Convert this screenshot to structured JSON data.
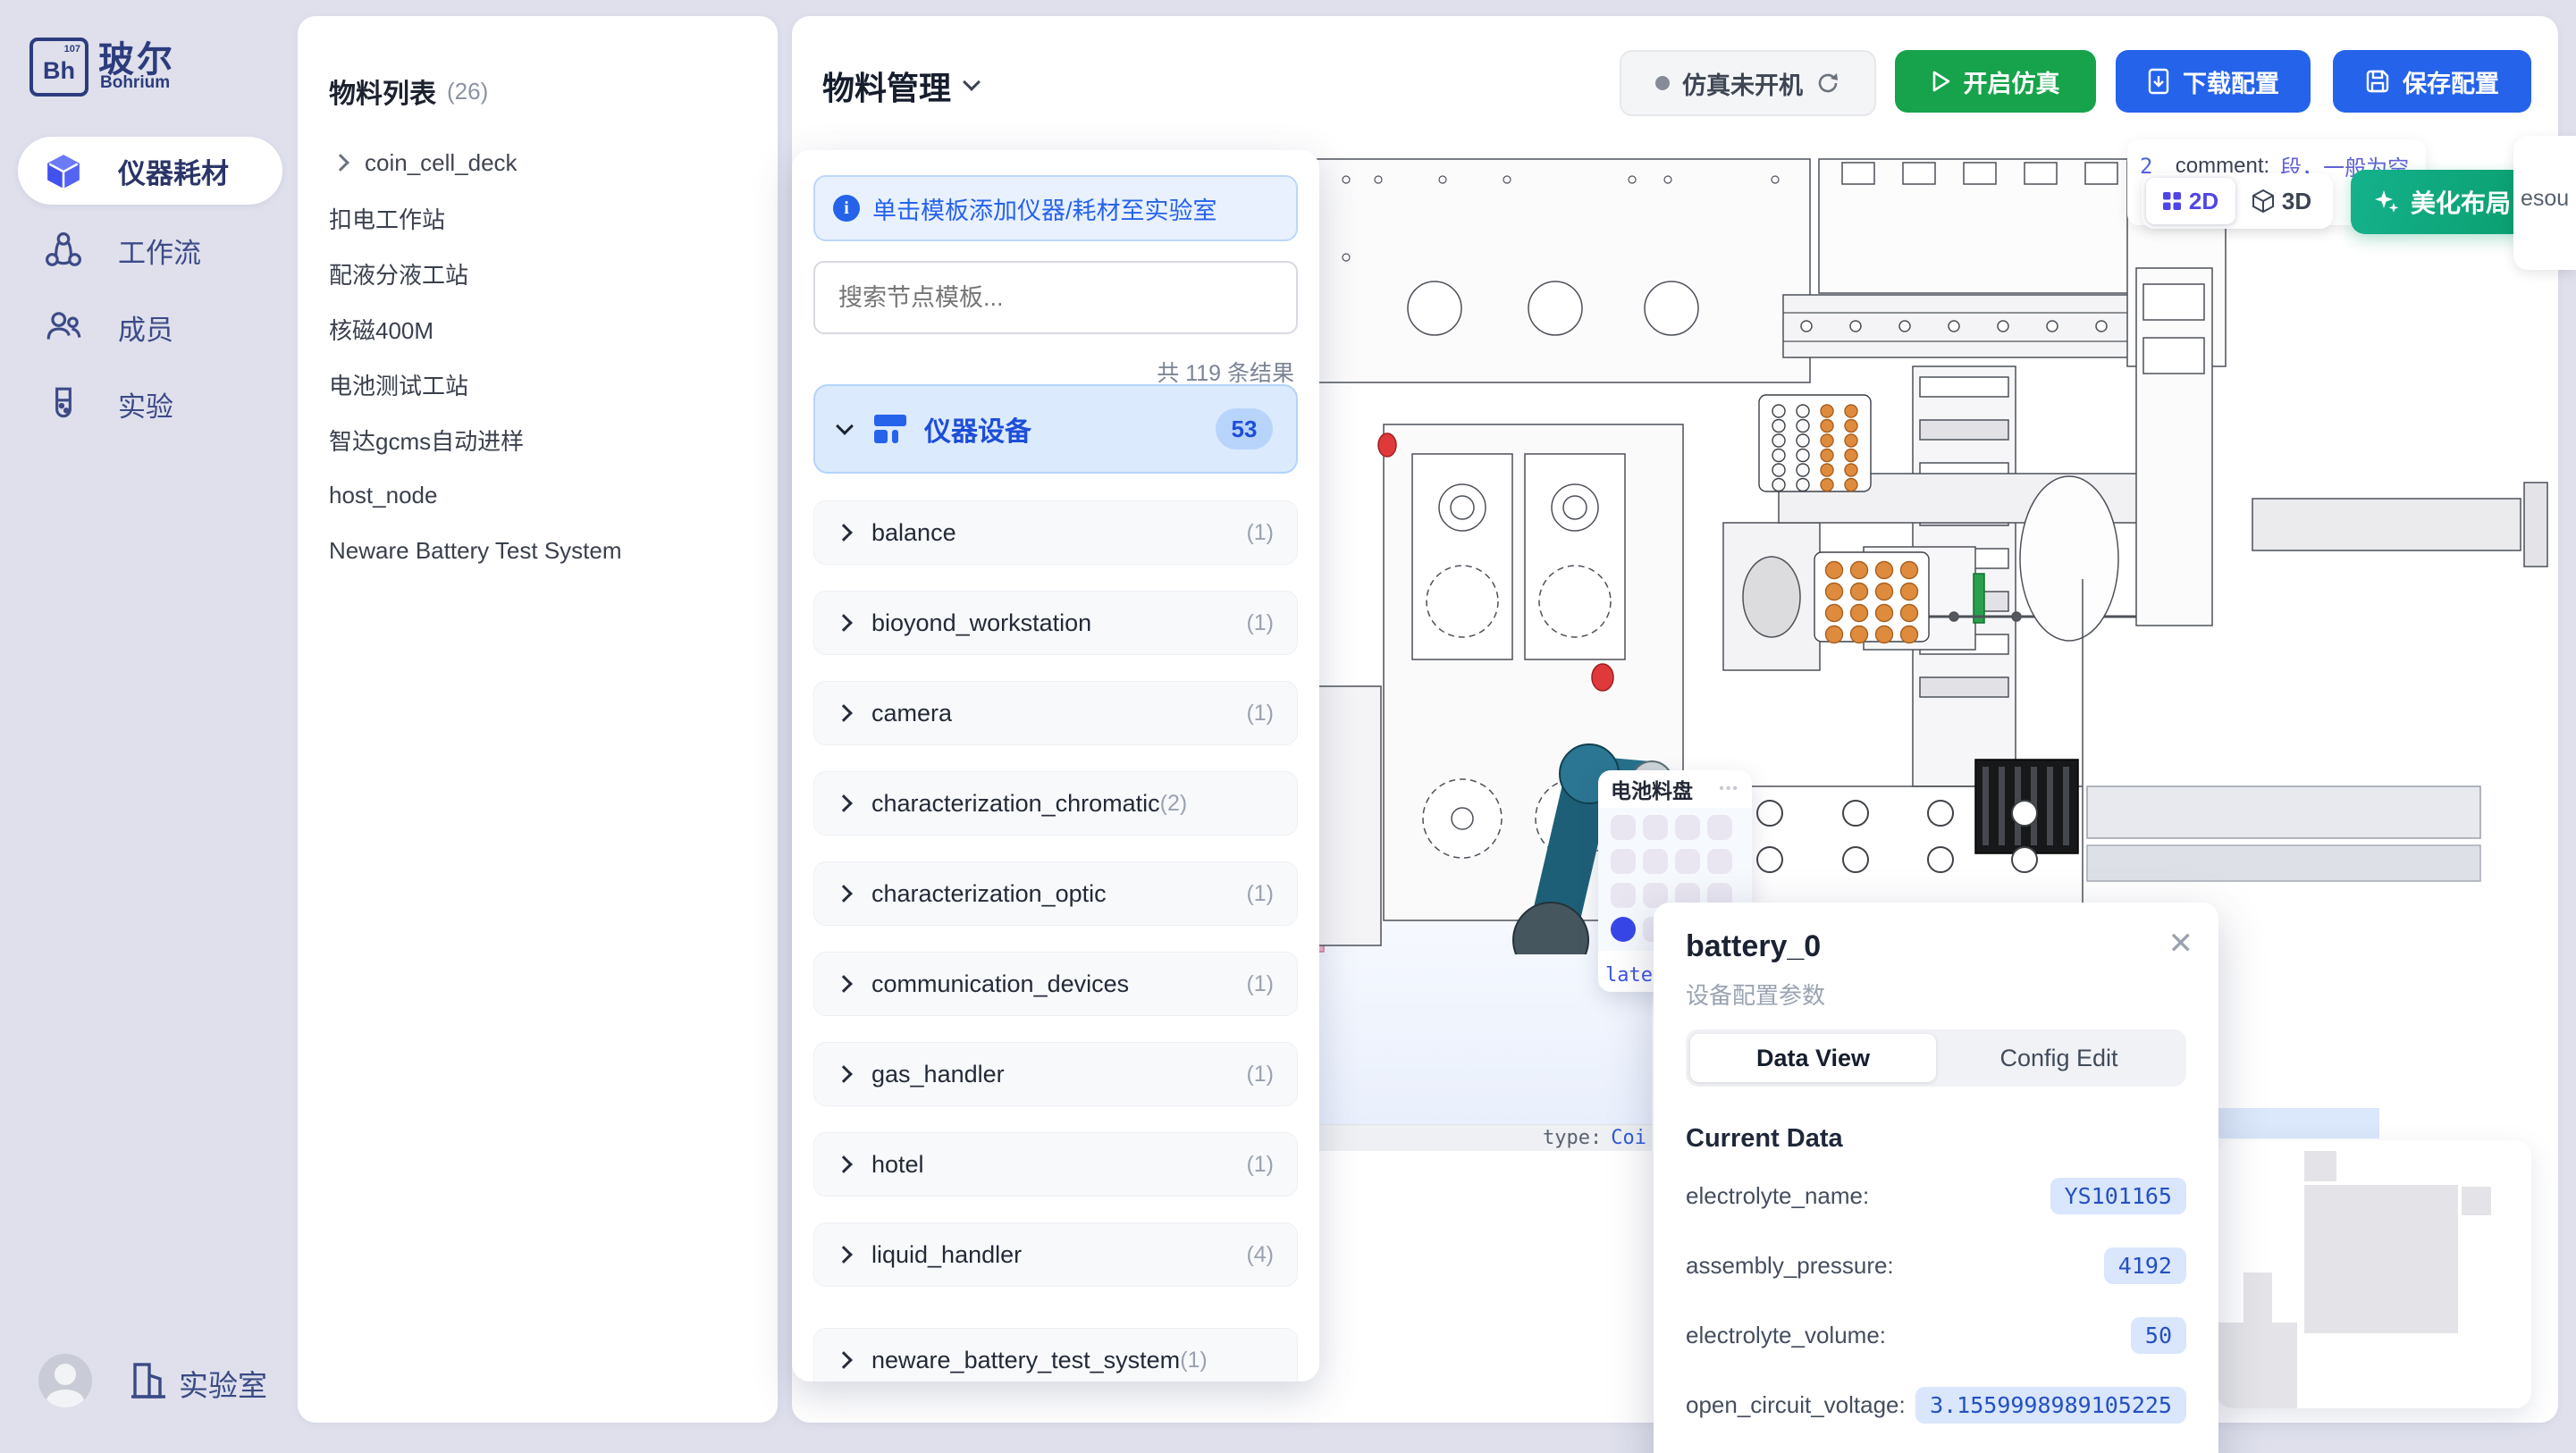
{
  "sidebar": {
    "logo": {
      "box_text": "Bh",
      "box_sup": "107",
      "title": "玻尔",
      "subtitle": "Bohrium"
    },
    "items": [
      {
        "label": "仪器耗材",
        "active": true
      },
      {
        "label": "工作流",
        "active": false
      },
      {
        "label": "成员",
        "active": false
      },
      {
        "label": "实验",
        "active": false
      }
    ],
    "footer_label": "实验室"
  },
  "materials_panel": {
    "title": "物料列表",
    "count": "(26)",
    "items": [
      {
        "label": "coin_cell_deck"
      },
      {
        "label": "扣电工作站"
      },
      {
        "label": "配液分液工站"
      },
      {
        "label": "核磁400M"
      },
      {
        "label": "电池测试工站"
      },
      {
        "label": "智达gcms自动进样"
      },
      {
        "label": "host_node"
      },
      {
        "label": "Neware Battery Test System"
      }
    ]
  },
  "header": {
    "title": "物料管理",
    "sim_status": "仿真未开机",
    "start_button": "开启仿真",
    "download_button": "下载配置",
    "save_button": "保存配置"
  },
  "template_panel": {
    "banner": "单击模板添加仪器/耗材至实验室",
    "search_placeholder": "搜索节点模板...",
    "result_count": "共 119 条结果",
    "group": {
      "label": "仪器设备",
      "badge": "53"
    },
    "categories": [
      {
        "name": "balance",
        "count": "(1)"
      },
      {
        "name": "bioyond_workstation",
        "count": "(1)"
      },
      {
        "name": "camera",
        "count": "(1)"
      },
      {
        "name": "characterization_chromatic",
        "count": "(2)"
      },
      {
        "name": "characterization_optic",
        "count": "(1)"
      },
      {
        "name": "communication_devices",
        "count": "(1)"
      },
      {
        "name": "gas_handler",
        "count": "(1)"
      },
      {
        "name": "hotel",
        "count": "(1)"
      },
      {
        "name": "liquid_handler",
        "count": "(4)"
      },
      {
        "name": "neware_battery_test_system",
        "count": "(1)"
      }
    ]
  },
  "canvas": {
    "comment_tooltip": {
      "index": "2",
      "key": "_comment:",
      "value": "段，一般为空，stat",
      "value_line2": "此固定"
    },
    "view_toggle": {
      "label_2d": "2D",
      "label_3d": "3D"
    },
    "beautify_button": "美化布局",
    "clipped_right_text": "esou",
    "plate_card": {
      "title": "电池料盘",
      "menu": "•••",
      "clipped_value": "late"
    },
    "node_footer": {
      "key": "type:",
      "value": "Coi"
    }
  },
  "popup": {
    "title": "battery_0",
    "subtitle": "设备配置参数",
    "tabs": [
      {
        "label": "Data View"
      },
      {
        "label": "Config Edit"
      }
    ],
    "active_tab": "Data View",
    "section_title": "Current Data",
    "fields": [
      {
        "label": "electrolyte_name:",
        "value": "YS101165"
      },
      {
        "label": "assembly_pressure:",
        "value": "4192"
      },
      {
        "label": "electrolyte_volume:",
        "value": "50"
      },
      {
        "label": "open_circuit_voltage:",
        "value": "3.1559998989105225"
      },
      {
        "label": "data_electrolyte_code:",
        "value": "LG000014"
      }
    ]
  },
  "colors": {
    "accent_blue": "#2563eb",
    "green": "#17a34b",
    "teal": "#0ca678",
    "indigo": "#4f46e5",
    "value_blue": "#2450c0"
  }
}
